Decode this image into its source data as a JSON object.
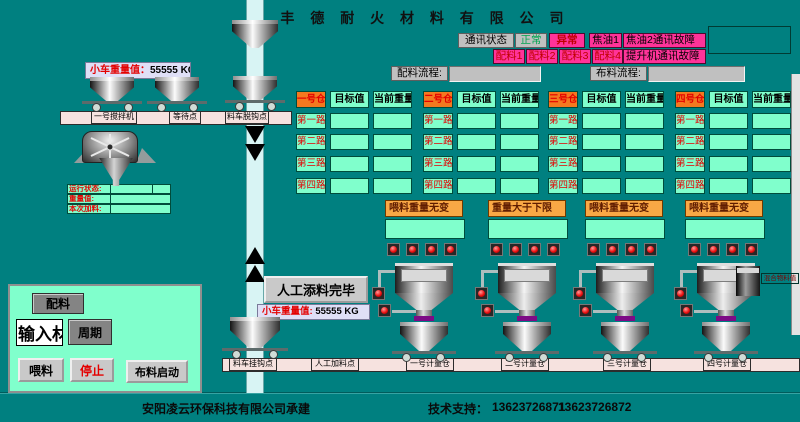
{
  "title": "聚 丰 德 耐 火 材 料 有 限 公 司",
  "comm": {
    "status_label": "通讯状态",
    "normal": "正常",
    "abnormal": "异常",
    "tar1": "焦油1",
    "tar2_fault": "焦油2通讯故障",
    "batch_tags": [
      "配料1",
      "配料2",
      "配料3",
      "配料4"
    ],
    "hoist_fault": "提升机通讯故障"
  },
  "flows": {
    "batch_label": "配料流程:",
    "dist_label": "布料流程:"
  },
  "cart_top": {
    "label": "小车重量值：",
    "value": "55555 KG"
  },
  "cart_bottom": {
    "label": "小车重量值:",
    "value": "55555 KG"
  },
  "rail_top": [
    "一号搅拌机",
    "等待点",
    "料车脱钩点"
  ],
  "rail_bottom": [
    "料车挂钩点",
    "人工加料点",
    "一号计量仓",
    "二号计量仓",
    "三号计量仓",
    "四号计量仓"
  ],
  "mixer_status": [
    {
      "label": "运行状态:"
    },
    {
      "label": "重量值:"
    },
    {
      "label": "本次加料:"
    }
  ],
  "bins": [
    {
      "name": "一号仓",
      "headers": [
        "目标值",
        "当前重量"
      ],
      "rows": [
        "第一路",
        "第二路",
        "第三路",
        "第四路"
      ],
      "alert": "喂料重量无变"
    },
    {
      "name": "二号仓",
      "headers": [
        "目标值",
        "当前重量"
      ],
      "rows": [
        "第一路",
        "第二路",
        "第三路",
        "第四路"
      ],
      "alert": "重量大于下限"
    },
    {
      "name": "三号仓",
      "headers": [
        "目标值",
        "当前重量"
      ],
      "rows": [
        "第一路",
        "第二路",
        "第三路",
        "第四路"
      ],
      "alert": "喂料重量无变"
    },
    {
      "name": "四号仓",
      "headers": [
        "目标值",
        "当前重量"
      ],
      "rows": [
        "第一路",
        "第二路",
        "第三路",
        "第四路"
      ],
      "alert": "喂料重量无变"
    }
  ],
  "panel": {
    "batch": "配料",
    "material_input": "输入材料",
    "cycle": "周期",
    "feed": "喂料",
    "stop": "停止",
    "dist_start": "布料启动"
  },
  "manual_done": "人工添料完毕",
  "mix_label": "混合物料值",
  "footer": {
    "company": "安阳凌云环保科技有限公司承建",
    "support_label": "技术支持：",
    "phone1": "13623726871",
    "phone2": "13623726872"
  },
  "colors": {
    "teal": "#008080",
    "mint": "#80ffcc",
    "orange": "#f4791f",
    "alert-orange": "#f9a845",
    "magenta": "#ff3399",
    "red": "#e40000",
    "gray": "#c0c0c0",
    "lavender": "#dfdff6",
    "railpink": "#f6e2df",
    "conveyor": "#d8f4f4",
    "purple": "#7d0b86"
  }
}
